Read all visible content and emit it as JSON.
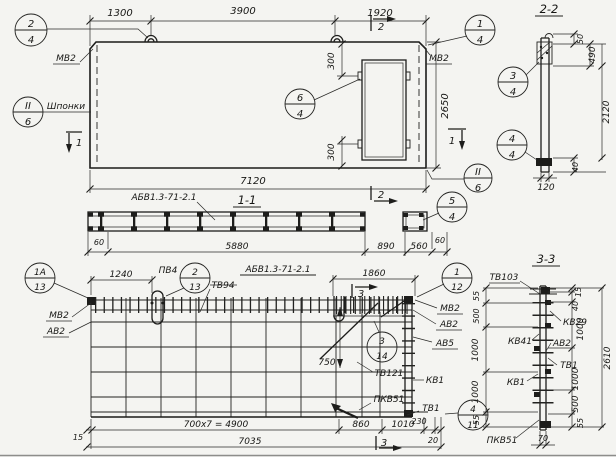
{
  "top_view": {
    "dim_1300": "1300",
    "dim_3900": "3900",
    "dim_1920": "1920",
    "dim_7120": "7120",
    "dim_2650": "2650",
    "dim_300_top": "300",
    "dim_300_bottom": "300",
    "label_mv2_left": "МВ2",
    "label_mv2_right": "МВ2",
    "label_shponki": "Шпонки",
    "marker_1_left": "1",
    "marker_1_right": "1",
    "marker_2_top": "2",
    "marker_2_bottom": "2"
  },
  "section_1_1": {
    "title": "1-1",
    "label_series": "АБВ1.3-71-2.1",
    "dim_60_left": "60",
    "dim_5880": "5880",
    "dim_890": "890",
    "dim_560": "560",
    "dim_60_right": "60"
  },
  "section_2_2": {
    "title": "2-2",
    "dim_50": "50",
    "dim_490": "490",
    "dim_2120": "2120",
    "dim_40": "40",
    "dim_120": "120"
  },
  "bottom_view": {
    "title_series": "АБВ1.3-71-2.1",
    "dim_1240": "1240",
    "dim_1860": "1860",
    "dim_750": "750",
    "label_pv4": "ПВ4",
    "label_tv94": "ТВ94",
    "label_mv2_left": "МВ2",
    "label_av2_left": "АВ2",
    "label_mv2_right": "МВ2",
    "label_av2_right": "АВ2",
    "label_av5": "АВ5",
    "label_tv121": "ТВ121",
    "label_kv1": "КВ1",
    "label_pkv51": "ПКВ51",
    "label_tv1": "ТВ1",
    "dim_15": "15",
    "dim_700x7": "700x7 = 4900",
    "dim_860": "860",
    "dim_1010": "1010",
    "dim_230": "230",
    "dim_20": "20",
    "dim_7035": "7035",
    "marker_3_top": "3",
    "marker_3_bottom": "3"
  },
  "section_3_3": {
    "title": "3-3",
    "label_tv103": "ТВ103",
    "label_kv29": "КВ29",
    "label_kv41": "КВ41",
    "label_av2": "АВ2",
    "label_tv1": "ТВ1",
    "label_kv1": "КВ1",
    "label_pkv51": "ПКВ51",
    "dim_55_top_left": "55",
    "dim_500_left": "500",
    "dim_1000_left_a": "1000",
    "dim_1000_left_b": "1000",
    "dim_55_bottom_left": "55",
    "dim_15_right": "15",
    "dim_40_right": "40",
    "dim_1000_right_a": "1000",
    "dim_1000_right_b": "1000",
    "dim_500_right": "500",
    "dim_55_right": "55",
    "dim_2610": "2610",
    "dim_70": "70"
  },
  "callouts": [
    {
      "top": "2",
      "bottom": "4"
    },
    {
      "top": "II",
      "bottom": "6"
    },
    {
      "top": "1",
      "bottom": "4"
    },
    {
      "top": "3",
      "bottom": "4"
    },
    {
      "top": "4",
      "bottom": "4"
    },
    {
      "top": "6",
      "bottom": "4"
    },
    {
      "top": "II",
      "bottom": "6"
    },
    {
      "top": "5",
      "bottom": "4"
    },
    {
      "top": "1А",
      "bottom": "13"
    },
    {
      "top": "2",
      "bottom": "13"
    },
    {
      "top": "1",
      "bottom": "12"
    },
    {
      "top": "3",
      "bottom": "14"
    },
    {
      "top": "4",
      "bottom": "11"
    }
  ]
}
